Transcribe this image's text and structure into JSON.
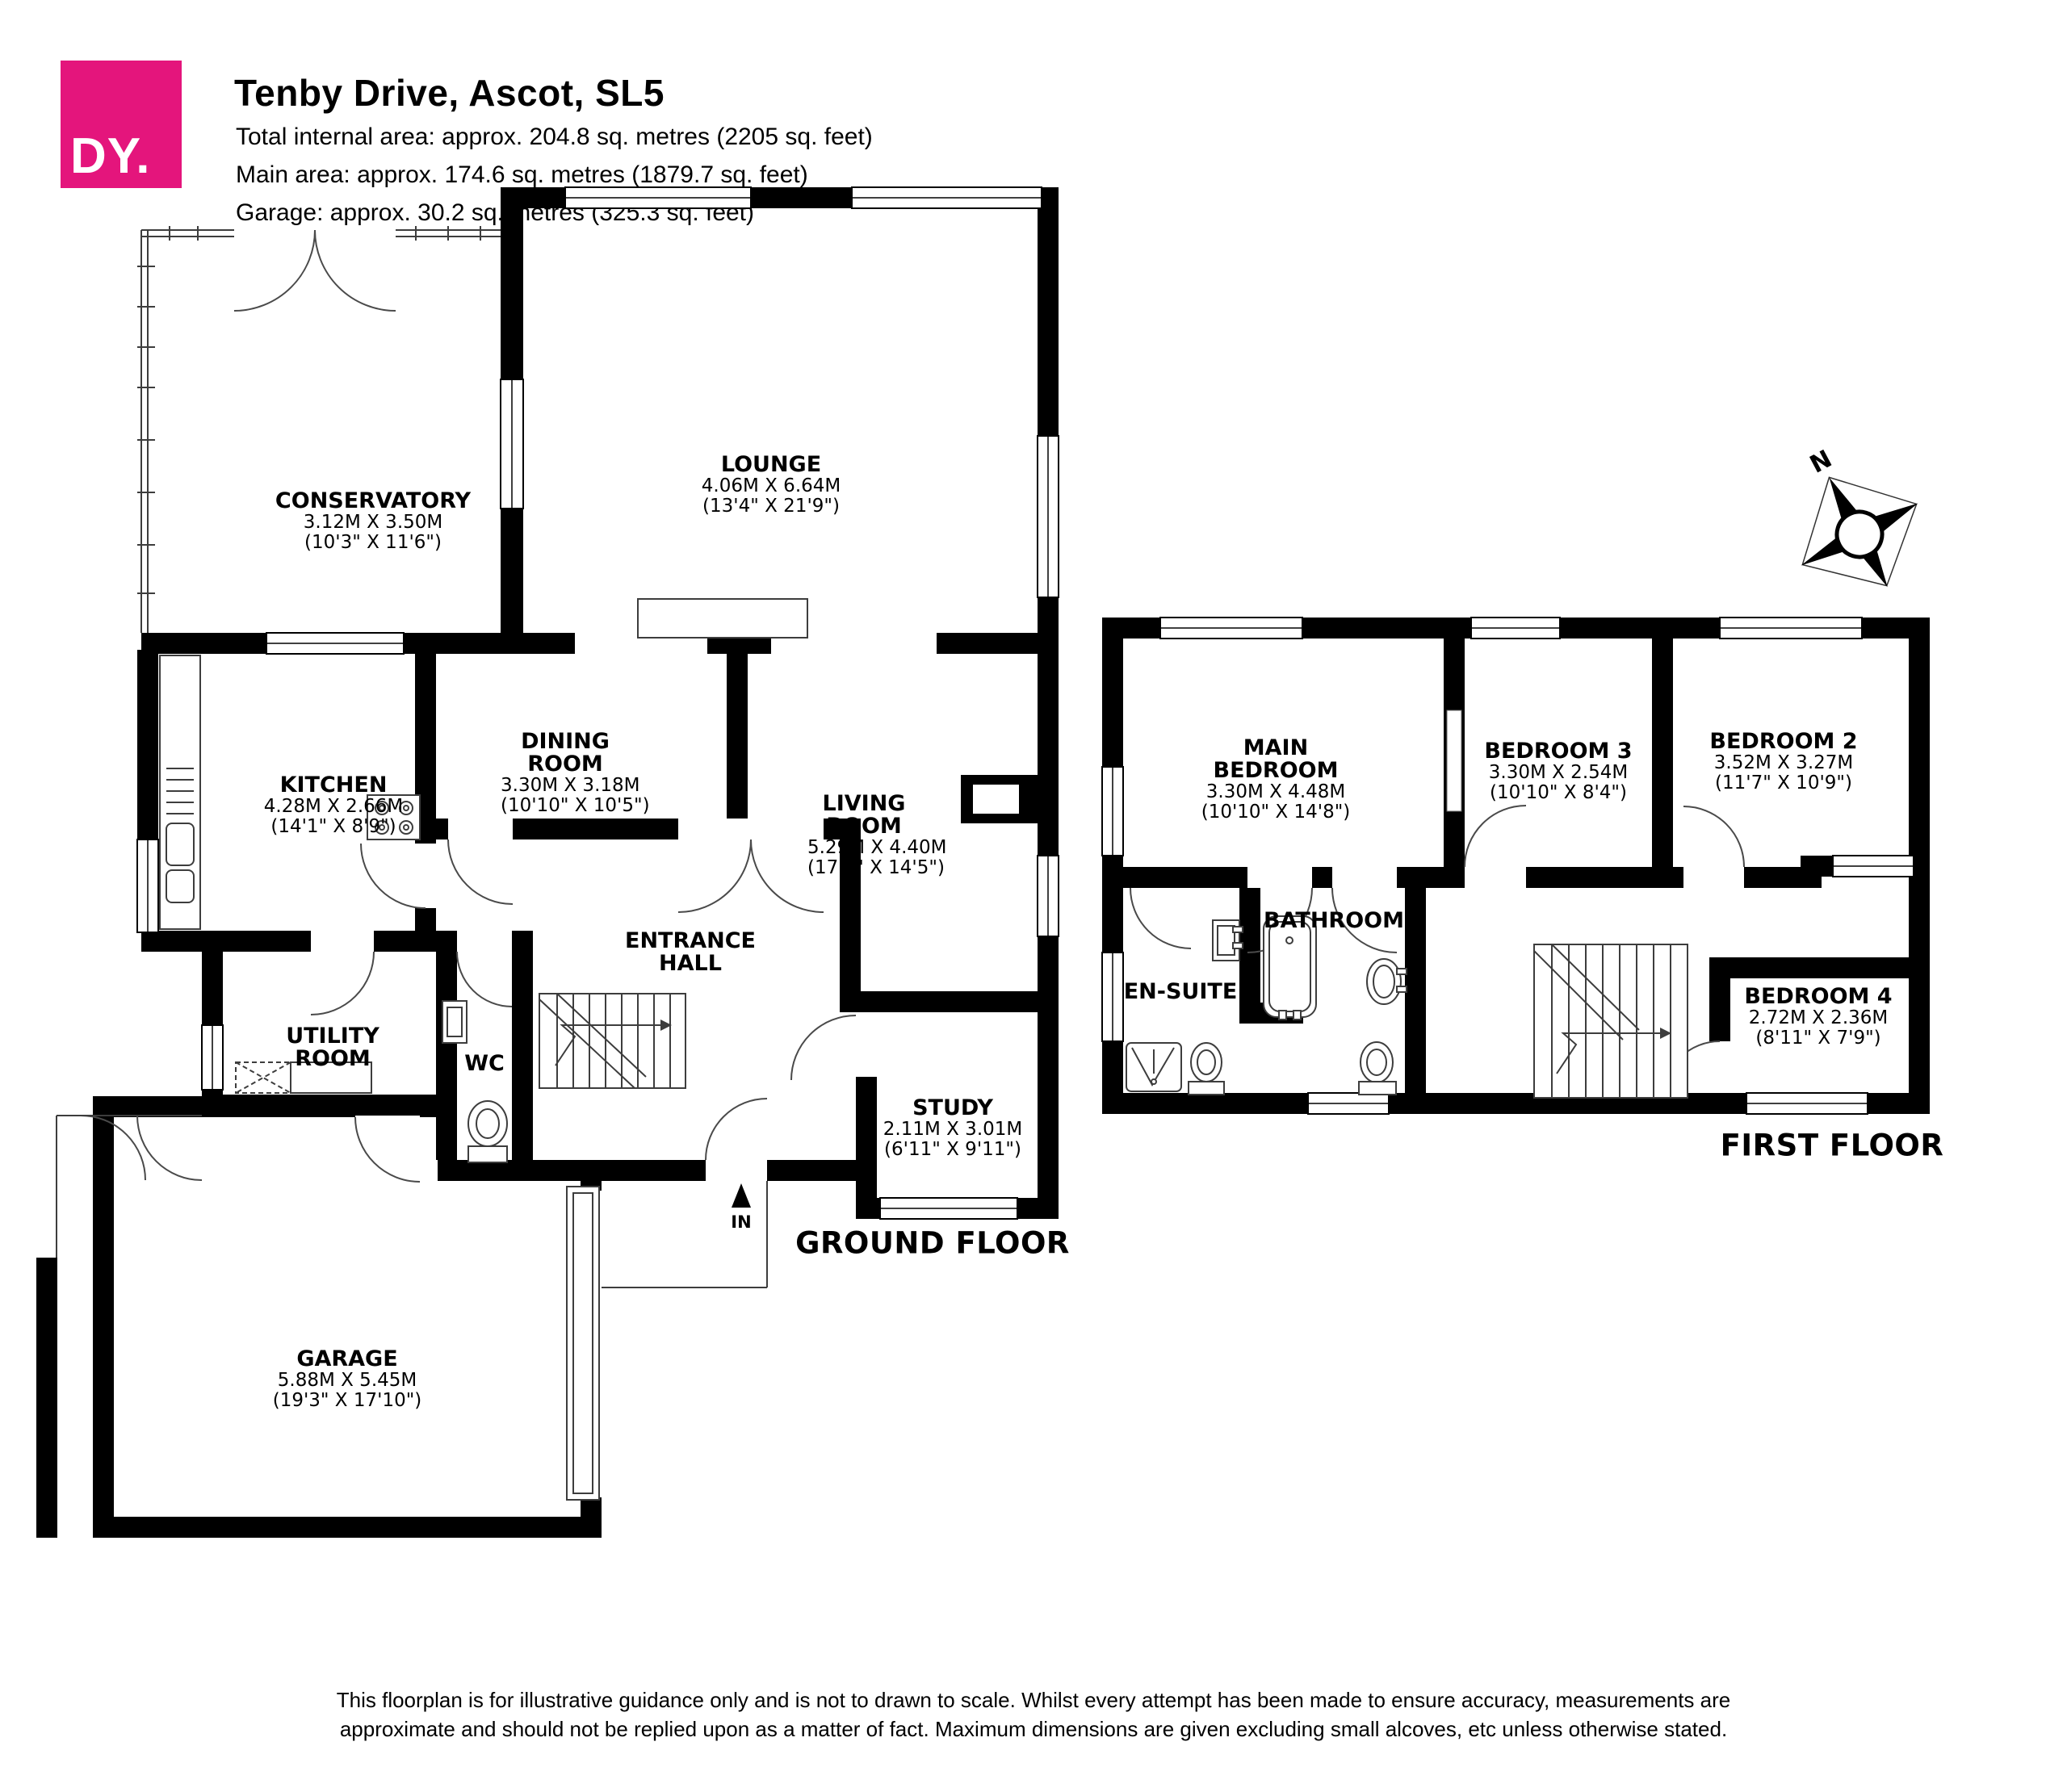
{
  "header": {
    "logo_text": "DY.",
    "title": "Tenby Drive, Ascot, SL5",
    "area_lines": [
      "Total internal area: approx. 204.8 sq. metres (2205 sq. feet)",
      "Main area: approx. 174.6 sq. metres (1879.7 sq. feet)",
      "Garage: approx. 30.2 sq. metres (325.3 sq. feet)"
    ]
  },
  "floors": {
    "ground": {
      "title": "GROUND FLOOR",
      "rooms": [
        {
          "name": "CONSERVATORY",
          "dims_m": "3.12M X 3.50M",
          "dims_ft": "(10'3\" X 11'6\")"
        },
        {
          "name": "LOUNGE",
          "dims_m": "4.06M X 6.64M",
          "dims_ft": "(13'4\" X 21'9\")"
        },
        {
          "name": "KITCHEN",
          "dims_m": "4.28M X 2.66M",
          "dims_ft": "(14'1\" X 8'9\")"
        },
        {
          "name": "DINING ROOM",
          "dims_m": "3.30M X 3.18M",
          "dims_ft": "(10'10\" X 10'5\")"
        },
        {
          "name": "LIVING ROOM",
          "dims_m": "5.29M X 4.40M",
          "dims_ft": "(17'4\" X 14'5\")"
        },
        {
          "name": "ENTRANCE HALL"
        },
        {
          "name": "UTILITY ROOM"
        },
        {
          "name": "WC"
        },
        {
          "name": "STUDY",
          "dims_m": "2.11M X 3.01M",
          "dims_ft": "(6'11\" X 9'11\")"
        },
        {
          "name": "GARAGE",
          "dims_m": "5.88M X 5.45M",
          "dims_ft": "(19'3\" X 17'10\")"
        }
      ]
    },
    "first": {
      "title": "FIRST FLOOR",
      "rooms": [
        {
          "name": "MAIN BEDROOM",
          "dims_m": "3.30M X 4.48M",
          "dims_ft": "(10'10\" X 14'8\")"
        },
        {
          "name": "BEDROOM 3",
          "dims_m": "3.30M X 2.54M",
          "dims_ft": "(10'10\" X 8'4\")"
        },
        {
          "name": "BEDROOM 2",
          "dims_m": "3.52M X 3.27M",
          "dims_ft": "(11'7\" X 10'9\")"
        },
        {
          "name": "BATHROOM"
        },
        {
          "name": "EN-SUITE"
        },
        {
          "name": "BEDROOM 4",
          "dims_m": "2.72M X 2.36M",
          "dims_ft": "(8'11\" X 7'9\")"
        }
      ]
    }
  },
  "compass": {
    "label": "N"
  },
  "entry": {
    "label": "IN"
  },
  "footer": {
    "line1": "This floorplan is for illustrative guidance only and is not to drawn to scale. Whilst every attempt has been made to ensure accuracy, measurements are",
    "line2": "approximate and should not be replied upon as a matter of fact. Maximum dimensions are given excluding small alcoves, etc unless otherwise stated."
  },
  "colors": {
    "brand_pink": "#E4157C",
    "wall": "#000000"
  }
}
